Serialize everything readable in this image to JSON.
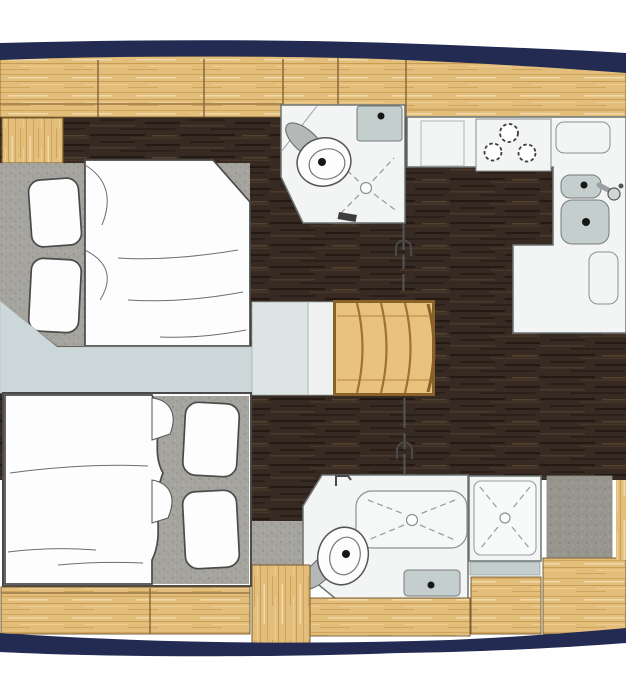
{
  "meta": {
    "title": "Sailing yacht interior layout - top-down floor plan, bow at left",
    "type": "floorplan"
  },
  "palette": {
    "page": "#ffffff",
    "hull": "#232b52",
    "wood": "#e3bd7a",
    "wood_grain": "#c89e55",
    "wood_frame": "#8a6128",
    "floor": "#362a22",
    "floor_streak": "#241a13",
    "carpet": "#a5a49f",
    "carpet_dot": "#8e8d88",
    "seat": "#97968f",
    "room": "#f3f5f4",
    "room_border": "#6d7374",
    "pale": "#ccd7d9",
    "landing_left": "#dde4e4",
    "landing_right": "#eef1f0",
    "sink": "#c3cecd",
    "lid": "#b4b9b8"
  },
  "areas": [
    {
      "id": "forward-cabin",
      "name": "Forward cabin",
      "fixtures": [
        "double-berth",
        "pillow",
        "pillow",
        "carpet-platform",
        "side-locker",
        "overhead-lockers"
      ]
    },
    {
      "id": "forward-head",
      "name": "Forward head",
      "fixtures": [
        "toilet",
        "washbasin",
        "shower-drain",
        "sliding-door"
      ]
    },
    {
      "id": "galley",
      "name": "Galley",
      "fixtures": [
        "three-burner-stove",
        "worktop",
        "locker-lid",
        "round-sink",
        "square-sink",
        "faucet",
        "counter-hatch"
      ]
    },
    {
      "id": "companionway",
      "name": "Companionway",
      "fixtures": [
        "curved-steps",
        "landing-panel"
      ]
    },
    {
      "id": "saloon-sole",
      "name": "Saloon sole",
      "fixtures": [
        "dark-wood-floor"
      ]
    },
    {
      "id": "aft-cabin",
      "name": "Aft cabin",
      "fixtures": [
        "double-berth",
        "pillow",
        "pillow",
        "carpet",
        "hull-lockers"
      ]
    },
    {
      "id": "aft-head",
      "name": "Aft head",
      "fixtures": [
        "toilet",
        "washbasin",
        "shower-tray",
        "sliding-door",
        "latch",
        "latch"
      ]
    },
    {
      "id": "aft-shower",
      "name": "Separate shower stall",
      "fixtures": [
        "shower-tray",
        "drain"
      ]
    },
    {
      "id": "hull",
      "name": "Hull side bands",
      "fixtures": [
        "top-sheer-band",
        "bottom-sheer-band"
      ]
    }
  ],
  "counts": {
    "cabins": 2,
    "heads": 2,
    "stove_burners": 3,
    "companionway_steps": 4,
    "pillows": 4,
    "galley_sinks": 2,
    "doors": 2,
    "shower_drains": 3
  }
}
